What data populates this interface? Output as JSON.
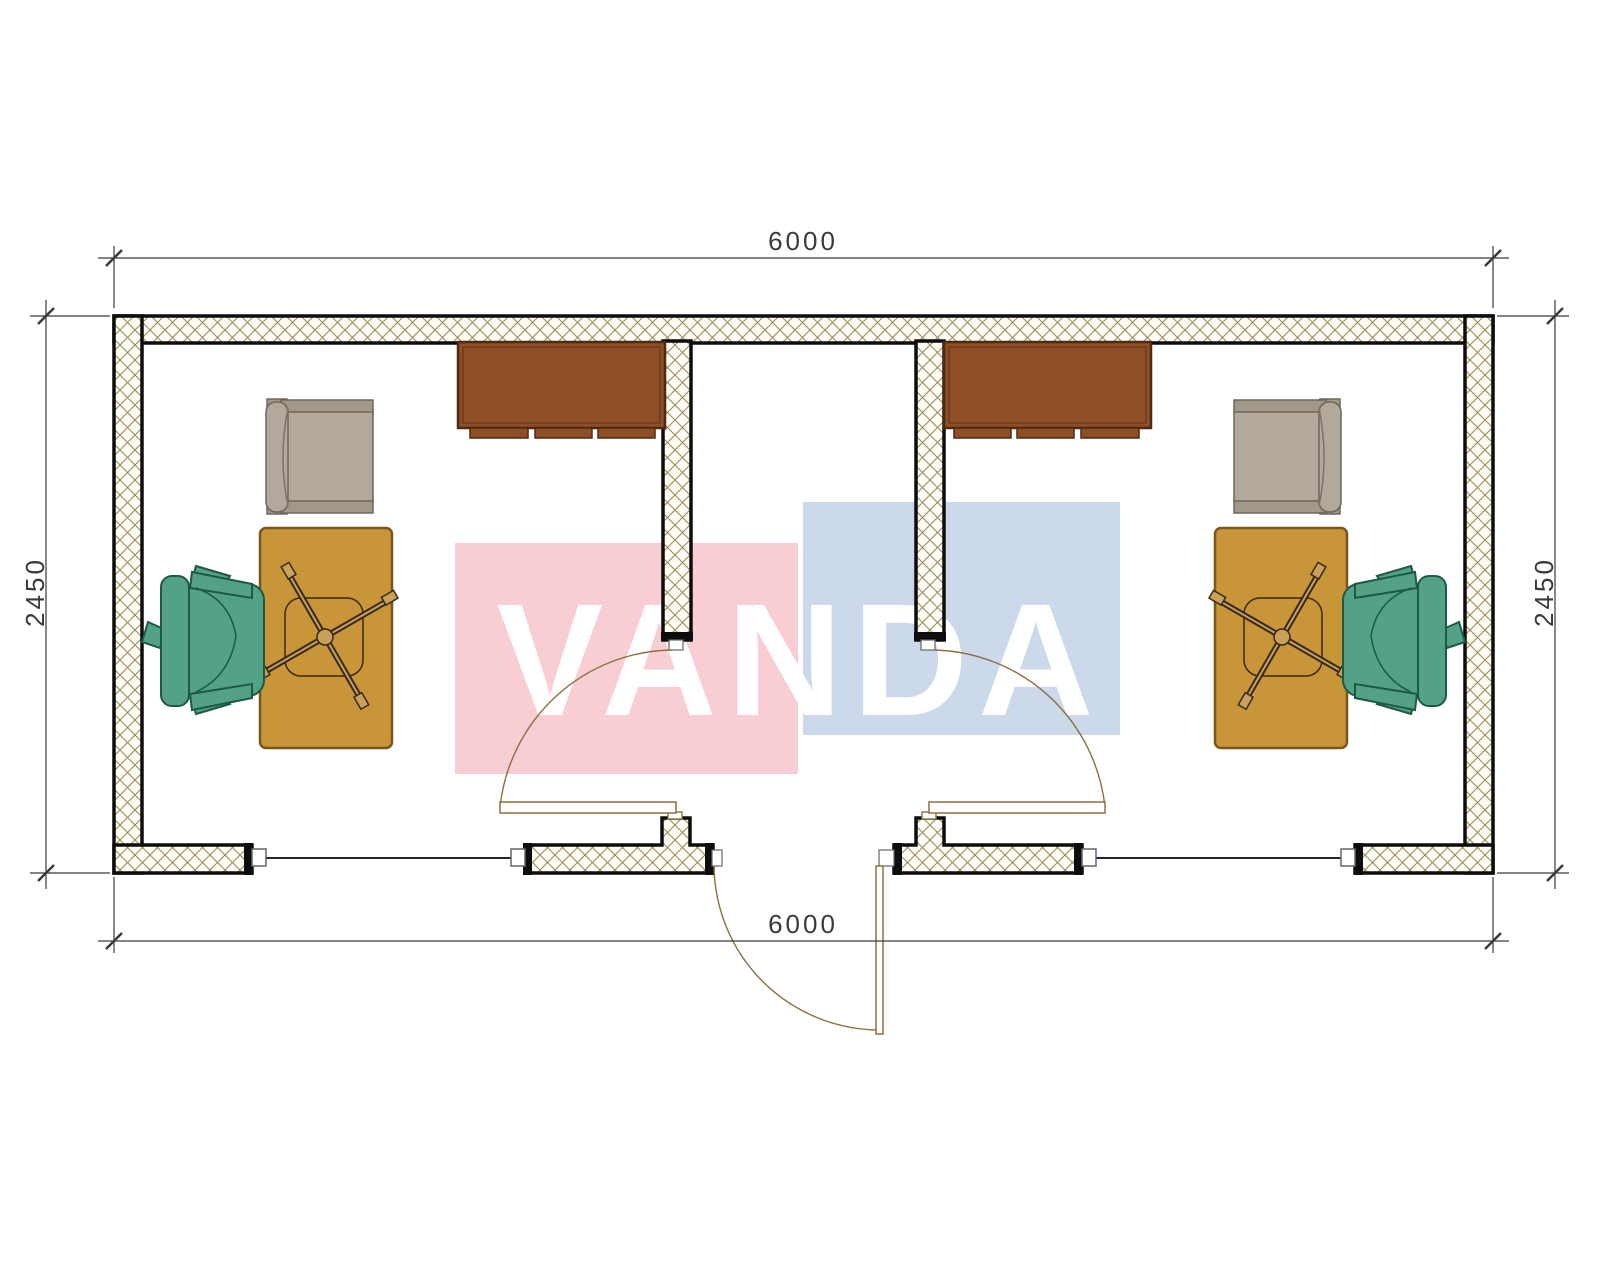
{
  "drawing": {
    "kind": "floor-plan",
    "units": "mm"
  },
  "dimensions": {
    "top": "6000",
    "bottom": "6000",
    "left": "2450",
    "right": "2450"
  },
  "watermark": {
    "text": "VANDA",
    "red_box_color": "#f8cdd3",
    "blue_box_color": "#ccd9ea",
    "text_color": "#ffffff"
  },
  "colors": {
    "wall_line": "#0d0d0d",
    "wall_hatch_line": "#9a8a5e",
    "wall_hatch_bg": "#fffdf6",
    "dimension_line": "#3a3a3a",
    "door_line": "#8d7040",
    "window_glass_line": "#23233a",
    "desk": "#c99539",
    "desk_outline": "#7a571e",
    "cabinet": "#8e4e26",
    "cabinet_outline": "#4e2a11",
    "executive_chair": "#53a287",
    "executive_chair_outline": "#1e5a42",
    "client_chair": "#b2a89c",
    "client_chair_dark": "#a29888",
    "client_chair_outline": "#6e665c"
  },
  "rooms": [
    {
      "name": "office-left",
      "furniture": [
        "wall-cabinet",
        "client-armchair",
        "desk",
        "office-chair-cross-base",
        "executive-chair"
      ]
    },
    {
      "name": "entrance-vestibule",
      "furniture": [
        "entrance-door-outward",
        "interior-door-to-left-office",
        "interior-door-to-right-office"
      ]
    },
    {
      "name": "office-right",
      "furniture": [
        "wall-cabinet",
        "client-armchair",
        "desk",
        "office-chair-cross-base",
        "executive-chair"
      ]
    }
  ],
  "openings": [
    "window-bottom-left",
    "window-bottom-right",
    "entrance-door-bottom-center"
  ]
}
